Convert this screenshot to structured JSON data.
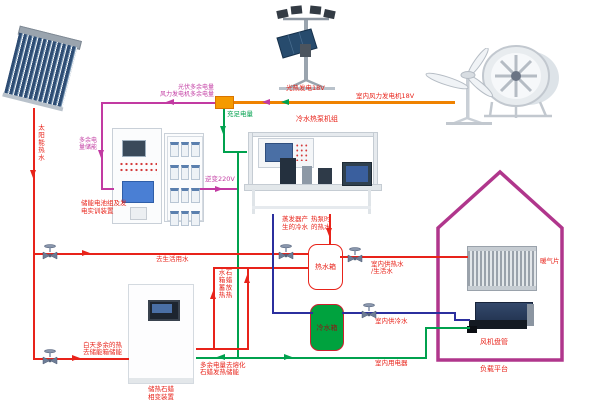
{
  "power": {
    "pv_surplus_line1": "光伏多余电量",
    "pv_surplus_line2": "风力发电机多余电量",
    "sufficient": "充足电量",
    "pv_generation": "光热发电18V",
    "wind_generation": "室内风力发电机18V",
    "inverter": "逆变220V",
    "store_line1": "多余电",
    "store_line2": "量储能",
    "melt_line1": "多余电量去熔化",
    "melt_line2": "石蜡发热储能",
    "indoor_appliances": "室内用电器"
  },
  "water": {
    "solar_hot": "太阳能热水",
    "to_domestic": "去生活用水",
    "day_surplus_line1": "白天多余的热",
    "day_surplus_line2": "去储能箱储能",
    "paraffin_release_col_right": "石蜡放热",
    "paraffin_release_col_left": "水箱蓄热",
    "evaporator_line1": "蒸发器产",
    "evaporator_line2": "生的冷水",
    "heatpump_hot_line1": "热泵时",
    "heatpump_hot_line2": "的热水",
    "indoor_hot_line1": "室内供热水",
    "indoor_hot_line2": "/生活水",
    "indoor_cold": "室内供冷水"
  },
  "devices": {
    "bench": "冷水热泵机组",
    "battery_cabinet_line1": "储能电池组及发",
    "battery_cabinet_line2": "电实训装置",
    "hot_tank": "热水箱",
    "cold_tank": "冷水箱",
    "paraffin_line1": "储热石蜡",
    "paraffin_line2": "相变装置",
    "radiator": "暖气片",
    "fan_coil": "风机盘管",
    "platform": "负载平台"
  },
  "colors": {
    "magenta_line": "#c23aa2",
    "orange_line": "#ef8200",
    "green_line": "#00a14e",
    "red_line": "#e8231a",
    "blue_line": "#2b2f9e",
    "house_outline": "#b0368c",
    "cold_tank_fill": "#00a23e"
  }
}
